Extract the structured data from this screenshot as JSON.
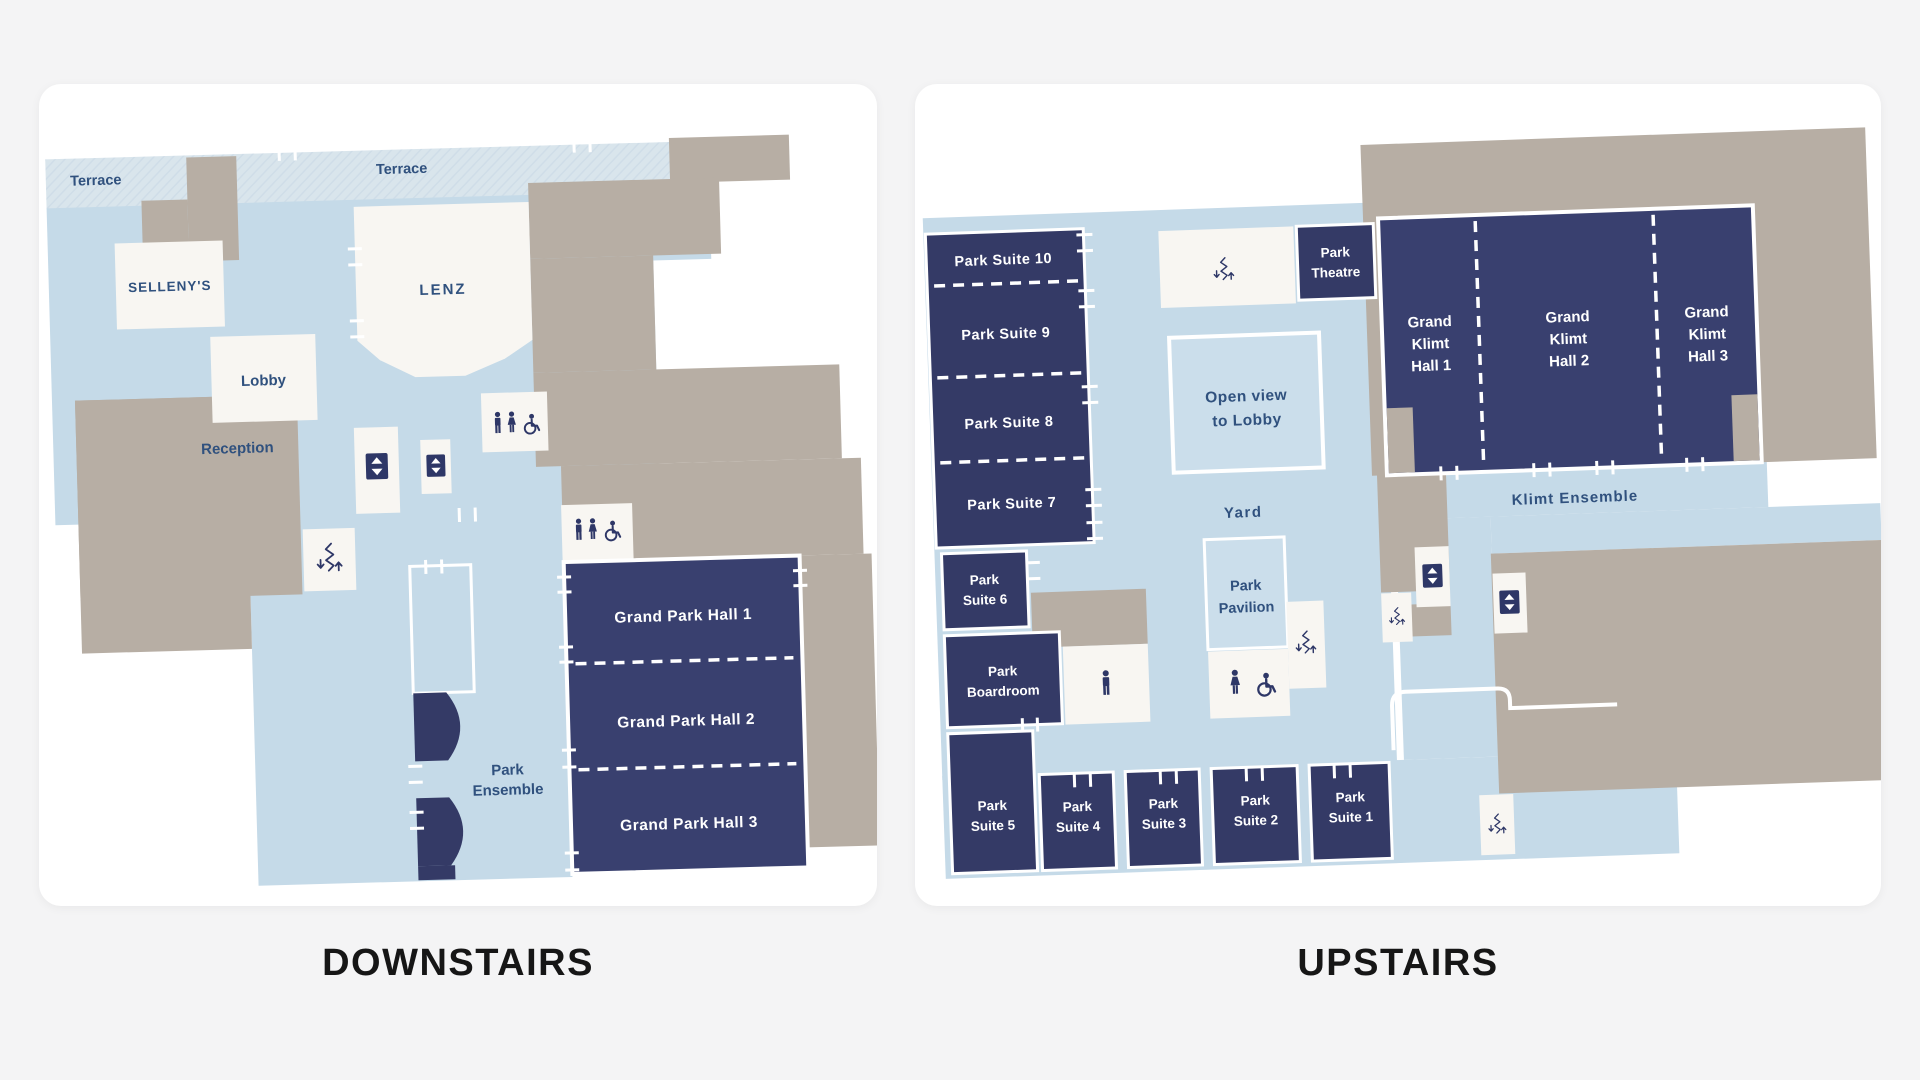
{
  "titles": {
    "downstairs": "DOWNSTAIRS",
    "upstairs": "UPSTAIRS"
  },
  "colors": {
    "page_bg": "#f4f4f5",
    "card_bg": "#ffffff",
    "floor_blue": "#c5dae8",
    "terrace_hatch_blue": "#d9e5ec",
    "gray": "#b7aea4",
    "room_white": "#f8f6f2",
    "navy_suites": "#343a66",
    "navy_halls": "#39406f",
    "label_blue": "#30517e",
    "title_text": "#161616"
  },
  "icons": {
    "elevator": "up-down-triangle-buttons",
    "stairs": "zigzag-with-down-and-up-arrows",
    "man": "male-figure",
    "woman": "female-figure",
    "wheelchair": "wheelchair-accessible-symbol"
  },
  "downstairs": {
    "terrace_left": "Terrace",
    "terrace_right": "Terrace",
    "sellenys": "SELLENY'S",
    "lenz": "LENZ",
    "lobby": "Lobby",
    "reception": "Reception",
    "park_ensemble": {
      "l1": "Park",
      "l2": "Ensemble"
    },
    "halls": [
      {
        "label": "Grand Park Hall 1"
      },
      {
        "label": "Grand Park Hall 2"
      },
      {
        "label": "Grand Park Hall 3"
      }
    ]
  },
  "upstairs": {
    "suites_column": [
      {
        "label": "Park Suite 10"
      },
      {
        "label": "Park Suite 9"
      },
      {
        "label": "Park Suite 8"
      },
      {
        "label": "Park Suite 7"
      }
    ],
    "suite6": {
      "l1": "Park",
      "l2": "Suite 6"
    },
    "boardroom": {
      "l1": "Park",
      "l2": "Boardroom"
    },
    "suite5": {
      "l1": "Park",
      "l2": "Suite 5"
    },
    "bottom_suites": [
      {
        "l1": "Park",
        "l2": "Suite 4"
      },
      {
        "l1": "Park",
        "l2": "Suite 3"
      },
      {
        "l1": "Park",
        "l2": "Suite 2"
      },
      {
        "l1": "Park",
        "l2": "Suite 1"
      }
    ],
    "theatre": {
      "l1": "Park",
      "l2": "Theatre"
    },
    "klimt_halls": [
      {
        "l1": "Grand",
        "l2": "Klimt",
        "l3": "Hall 1"
      },
      {
        "l1": "Grand",
        "l2": "Klimt",
        "l3": "Hall 2"
      },
      {
        "l1": "Grand",
        "l2": "Klimt",
        "l3": "Hall 3"
      }
    ],
    "open_view": {
      "l1": "Open view",
      "l2": "to Lobby"
    },
    "yard": "Yard",
    "klimt_ensemble": "Klimt Ensemble",
    "pavilion": {
      "l1": "Park",
      "l2": "Pavilion"
    }
  }
}
